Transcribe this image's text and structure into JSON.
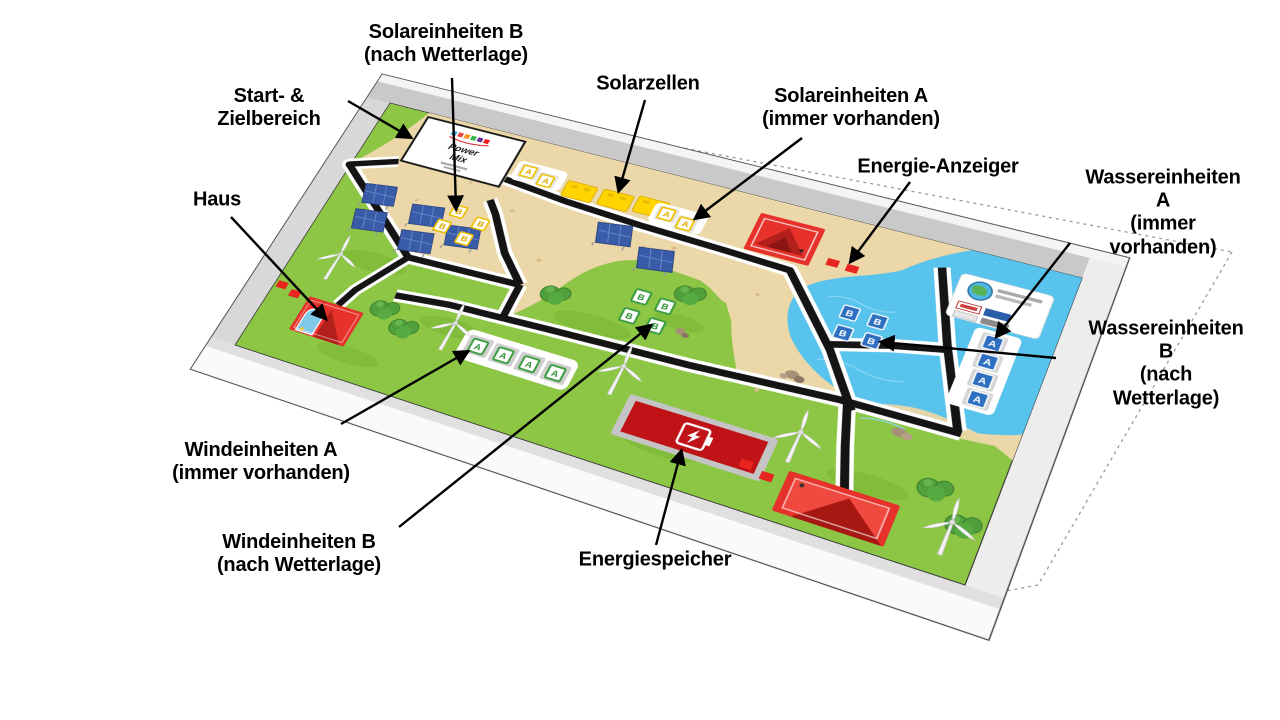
{
  "labels": {
    "solareinheiten_b": "Solareinheiten B\n(nach Wetterlage)",
    "start_ziel": "Start- &\nZielbereich",
    "solarzellen": "Solarzellen",
    "solareinheiten_a": "Solareinheiten A\n(immer vorhanden)",
    "energie_anzeiger": "Energie-Anzeiger",
    "wassereinheiten_a": "Wassereinheiten A\n(immer vorhanden)",
    "haus": "Haus",
    "wassereinheiten_b": "Wassereinheiten B\n(nach Wetterlage)",
    "windeinheiten_a": "Windeinheiten A\n(immer vorhanden)",
    "windeinheiten_b": "Windeinheiten B\n(nach Wetterlage)",
    "energiespeicher": "Energiespeicher"
  },
  "board": {
    "start_area": {
      "title_line1": "Power",
      "title_line2": "Mix"
    },
    "tile_letters": {
      "solar_a": "A",
      "solar_b": "B",
      "wind_a": "A",
      "wind_b": "B",
      "water_a": "A",
      "water_b": "B"
    },
    "colors": {
      "grass": "#8CC644",
      "sand": "#EBD7A8",
      "water": "#58C3EC",
      "track": "#141414",
      "marker_red": "#E8241E",
      "solar_yellow": "#F5C400",
      "wind_green": "#3C9C40",
      "water_blue": "#2E6FC0",
      "house_red": "#E6322A",
      "storage_red": "#BF1318"
    }
  }
}
